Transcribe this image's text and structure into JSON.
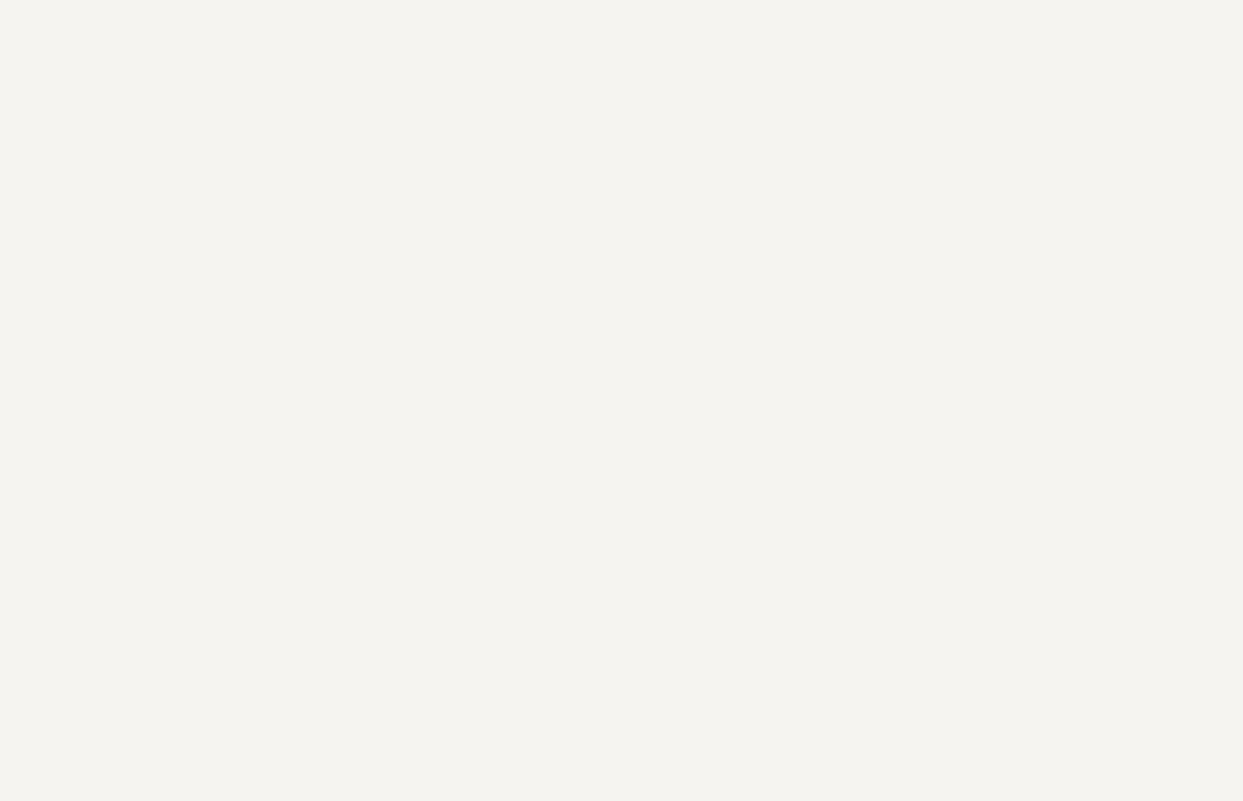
{
  "title": "STABILIZER 5/24V 1.915.106 22.6.83 /1.915.108",
  "colors": {
    "bg": "#f5f4f0",
    "ink": "#1c1c1c"
  },
  "note": [
    {
      "t": "∂",
      "x": 605,
      "y": 651,
      "s": 7
    },
    {
      "t": "R",
      "x": 614,
      "y": 651
    },
    {
      "t": "L",
      "x": 620,
      "y": 653,
      "s": 4.5
    },
    {
      "t": "= ∞ ,",
      "x": 626,
      "y": 651
    },
    {
      "t": "R",
      "x": 646,
      "y": 651
    },
    {
      "t": "v",
      "x": 652,
      "y": 653,
      "s": 4.5
    },
    {
      "t": "= ∞ :",
      "x": 658,
      "y": 651
    },
    {
      "t": "U",
      "x": 677,
      "y": 651
    },
    {
      "t": "out",
      "x": 684,
      "y": 653,
      "s": 4.5
    },
    {
      "t": "= 24V",
      "x": 695,
      "y": 651
    },
    {
      "t": "I",
      "x": 726,
      "y": 651
    },
    {
      "t": "out",
      "x": 730,
      "y": 653,
      "s": 4.5
    },
    {
      "t": "ca 4,5A",
      "x": 742,
      "y": 651
    }
  ],
  "connector": {
    "pin_first": 32,
    "pin_last": 1,
    "tracking_label": "TRACKING",
    "tracking_letters": [
      "A",
      "B",
      "C",
      "D",
      "E",
      "F",
      "G"
    ],
    "tracking_pins": [
      31,
      30,
      29,
      28,
      27,
      26,
      25
    ],
    "output_label": "OUTPUT",
    "output_plus_pins": [
      24,
      23,
      22,
      21
    ],
    "key_label": "KEY",
    "key_pin": 15,
    "rv_pin": 13,
    "rc_from_pin": 18,
    "aux_pin": 20,
    "out_label": "OUT.",
    "out_minus_pins": [
      11,
      10,
      9,
      8
    ],
    "inp_label": "INP.",
    "inp_plus_pins": [
      7,
      6,
      5
    ],
    "inp_minus_pins": [
      4,
      3,
      2
    ],
    "voltage_adjust": [
      "OUTPUT",
      "VOLTAGE",
      "ADJUST"
    ],
    "current_adjust": [
      "OUTPUT",
      "CURRENT",
      "ADJUST"
    ],
    "plus_mark": "+",
    "minus_mark": "−",
    "rv_label_main": "R",
    "rv_label_sub": "v",
    "rc_label_main": "R",
    "rc_label_sub": "c"
  },
  "labels": [
    {
      "t": "R",
      "x": 212,
      "y": 42,
      "s": 7
    },
    {
      "t": "c",
      "x": 219,
      "y": 44,
      "s": 5
    },
    {
      "t": "P4/18",
      "x": 170,
      "y": 61
    },
    {
      "t": "( 5 )",
      "x": 237,
      "y": 61
    },
    {
      "t": "P4/5",
      "x": 116,
      "y": 83
    },
    {
      "t": "P4/6",
      "x": 116,
      "y": 100
    },
    {
      "t": "P4/7",
      "x": 116,
      "y": 120
    },
    {
      "t": "INPUTS",
      "x": 138,
      "y": 140
    },
    {
      "t": "R2",
      "x": 245,
      "y": 114
    },
    {
      "t": "1,8k",
      "x": 245,
      "y": 123
    },
    {
      "t": "2X",
      "x": 281,
      "y": 151
    },
    {
      "t": "BC307B",
      "x": 264,
      "y": 160
    },
    {
      "t": "Q1",
      "x": 210,
      "y": 172
    },
    {
      "t": "Q2",
      "x": 312,
      "y": 175
    },
    {
      "t": "R3",
      "x": 314,
      "y": 195
    },
    {
      "t": "40k",
      "x": 314,
      "y": 215
    },
    {
      "t": "BC307B",
      "x": 381,
      "y": 194
    },
    {
      "t": "Q3",
      "x": 384,
      "y": 203
    },
    {
      "t": "C5",
      "x": 315,
      "y": 122
    },
    {
      "t": "4,7µ",
      "x": 310,
      "y": 131
    },
    {
      "t": "25V",
      "x": 311,
      "y": 139
    },
    {
      "t": "R1",
      "x": 266,
      "y": 89
    },
    {
      "t": "0,1",
      "x": 267,
      "y": 108
    },
    {
      "t": "R4",
      "x": 419,
      "y": 220
    },
    {
      "t": "10k",
      "x": 419,
      "y": 240
    },
    {
      "t": "P4/31",
      "x": 446,
      "y": 61
    },
    {
      "t": "A",
      "x": 477,
      "y": 75
    },
    {
      "t": "R12",
      "x": 444,
      "y": 114
    },
    {
      "t": "1k",
      "x": 449,
      "y": 123
    },
    {
      "t": "C7",
      "x": 416,
      "y": 154
    },
    {
      "t": "0,1µ",
      "x": 443,
      "y": 153
    },
    {
      "t": "D5",
      "x": 518,
      "y": 127
    },
    {
      "t": "ZPD 4,3V",
      "x": 511,
      "y": 136
    },
    {
      "t": "MV5753",
      "x": 566,
      "y": 105
    },
    {
      "t": "DL6",
      "x": 571,
      "y": 113
    },
    {
      "t": "R16",
      "x": 541,
      "y": 156
    },
    {
      "t": "560",
      "x": 543,
      "y": 164
    },
    {
      "t": "R21",
      "x": 579,
      "y": 148
    },
    {
      "t": "180",
      "x": 581,
      "y": 156
    },
    {
      "t": "Q7",
      "x": 567,
      "y": 212
    },
    {
      "t": "BC307B",
      "x": 556,
      "y": 220
    },
    {
      "t": "C9",
      "x": 634,
      "y": 147
    },
    {
      "t": "47µ",
      "x": 630,
      "y": 155
    },
    {
      "t": "6,3V",
      "x": 628,
      "y": 163
    },
    {
      "t": "4V",
      "x": 704,
      "y": 191,
      "a": "m"
    },
    {
      "t": "K",
      "x": 712,
      "y": 133
    },
    {
      "t": "A",
      "x": 715,
      "y": 164
    },
    {
      "t": "D7",
      "x": 729,
      "y": 163
    },
    {
      "t": "TL431",
      "x": 725,
      "y": 171
    },
    {
      "t": "REF",
      "x": 732,
      "y": 141,
      "s": 5
    },
    {
      "t": "R26",
      "x": 757,
      "y": 141
    },
    {
      "t": "40k",
      "x": 758,
      "y": 149
    },
    {
      "t": "R28",
      "x": 783,
      "y": 109
    },
    {
      "t": "3,3k",
      "x": 781,
      "y": 117
    },
    {
      "t": "BC307B",
      "x": 786,
      "y": 143
    },
    {
      "t": "Q13",
      "x": 790,
      "y": 151
    },
    {
      "t": "R27",
      "x": 785,
      "y": 176
    },
    {
      "t": "NTC",
      "x": 786,
      "y": 183
    },
    {
      "t": "16,7k",
      "x": 783,
      "y": 191
    },
    {
      "t": "R25",
      "x": 757,
      "y": 204
    },
    {
      "t": "15k",
      "x": 758,
      "y": 212
    },
    {
      "t": "R29",
      "x": 795,
      "y": 204
    },
    {
      "t": "2,7",
      "x": 797,
      "y": 212
    },
    {
      "t": "R22",
      "x": 697,
      "y": 253
    },
    {
      "t": "5,6k",
      "x": 694,
      "y": 261
    },
    {
      "t": "OPTIONAL :",
      "x": 742,
      "y": 248
    },
    {
      "t": "THERMAL SWITCH OFF",
      "x": 740,
      "y": 258,
      "s": 6
    },
    {
      "t": "R31",
      "x": 749,
      "y": 290,
      "s": 6
    },
    {
      "t": "2k",
      "x": 752,
      "y": 298,
      "s": 6
    },
    {
      "t": "C10",
      "x": 774,
      "y": 268,
      "s": 6
    },
    {
      "t": "47µ",
      "x": 776,
      "y": 276,
      "s": 6
    },
    {
      "t": "BC307B",
      "x": 770,
      "y": 289,
      "s": 6
    },
    {
      "t": "Q19",
      "x": 775,
      "y": 297,
      "s": 6
    },
    {
      "t": "BC237B",
      "x": 788,
      "y": 320,
      "s": 6
    },
    {
      "t": "Q12",
      "x": 792,
      "y": 328,
      "s": 6
    },
    {
      "t": "R27",
      "x": 748,
      "y": 352,
      "s": 6
    },
    {
      "t": "16,7k",
      "x": 744,
      "y": 360,
      "s": 6
    },
    {
      "t": "R38",
      "x": 788,
      "y": 350,
      "s": 6
    },
    {
      "t": "1k",
      "x": 792,
      "y": 358,
      "s": 6
    },
    {
      "t": "Q14",
      "x": 866,
      "y": 297
    },
    {
      "t": "BC237B",
      "x": 856,
      "y": 305
    },
    {
      "t": "BC307B",
      "x": 932,
      "y": 258
    },
    {
      "t": "Q15",
      "x": 942,
      "y": 266
    },
    {
      "t": "BC237B",
      "x": 980,
      "y": 257
    },
    {
      "t": "Q17",
      "x": 984,
      "y": 265
    },
    {
      "t": "D11",
      "x": 869,
      "y": 140
    },
    {
      "t": "1N4448",
      "x": 862,
      "y": 149
    },
    {
      "t": "R30",
      "x": 870,
      "y": 194
    },
    {
      "t": "100k",
      "x": 866,
      "y": 202
    },
    {
      "t": "P4/30",
      "x": 835,
      "y": 60
    },
    {
      "t": "B",
      "x": 859,
      "y": 77
    },
    {
      "t": "P4/29",
      "x": 902,
      "y": 60
    },
    {
      "t": "C",
      "x": 926,
      "y": 77
    },
    {
      "t": "P4/25",
      "x": 948,
      "y": 60
    },
    {
      "t": "G",
      "x": 977,
      "y": 77
    },
    {
      "t": "P4/27",
      "x": 993,
      "y": 60
    },
    {
      "t": "E",
      "x": 1021,
      "y": 77
    },
    {
      "t": "P4/21",
      "x": 1114,
      "y": 65
    },
    {
      "t": "P4/22",
      "x": 1114,
      "y": 81
    },
    {
      "t": "P4/23",
      "x": 1114,
      "y": 100
    },
    {
      "t": "P4/24",
      "x": 1114,
      "y": 115
    },
    {
      "t": "OUTPUTS",
      "x": 1056,
      "y": 129
    },
    {
      "t": "P2",
      "x": 1046,
      "y": 157
    },
    {
      "t": "0V",
      "x": 1043,
      "y": 165
    },
    {
      "t": "P3",
      "x": 1070,
      "y": 231
    },
    {
      "t": "−1V",
      "x": 1066,
      "y": 239
    },
    {
      "t": "R34",
      "x": 948,
      "y": 308
    },
    {
      "t": "100k",
      "x": 943,
      "y": 316
    },
    {
      "t": "R32",
      "x": 991,
      "y": 308
    },
    {
      "t": "100k",
      "x": 986,
      "y": 316
    },
    {
      "t": "R33",
      "x": 1044,
      "y": 308
    },
    {
      "t": "100k",
      "x": 1044,
      "y": 316
    },
    {
      "t": "BC307B",
      "x": 975,
      "y": 348
    },
    {
      "t": "Q16",
      "x": 979,
      "y": 356
    },
    {
      "t": "BC307B",
      "x": 1043,
      "y": 381
    },
    {
      "t": "Q18",
      "x": 1047,
      "y": 389
    },
    {
      "t": "4X",
      "x": 110,
      "y": 308
    },
    {
      "t": "2200µ",
      "x": 100,
      "y": 316
    },
    {
      "t": "40V",
      "x": 106,
      "y": 324
    },
    {
      "t": "C1",
      "x": 133,
      "y": 303,
      "s": 6
    },
    {
      "t": "C2",
      "x": 151,
      "y": 303,
      "s": 6
    },
    {
      "t": "C3",
      "x": 169,
      "y": 303,
      "s": 6
    },
    {
      "t": "C4",
      "x": 187,
      "y": 303,
      "s": 6
    },
    {
      "t": "R5",
      "x": 224,
      "y": 300
    },
    {
      "t": "2,7",
      "x": 224,
      "y": 308
    },
    {
      "t": "D2",
      "x": 260,
      "y": 291
    },
    {
      "t": "1N4448",
      "x": 244,
      "y": 301
    },
    {
      "t": "D3",
      "x": 260,
      "y": 313
    },
    {
      "t": "R6",
      "x": 241,
      "y": 333
    },
    {
      "t": "1k",
      "x": 245,
      "y": 352
    },
    {
      "t": "Q4",
      "x": 193,
      "y": 366
    },
    {
      "t": "BD136-16",
      "x": 174,
      "y": 379
    },
    {
      "t": "1N4448",
      "x": 313,
      "y": 357
    },
    {
      "t": "D4",
      "x": 317,
      "y": 365
    },
    {
      "t": "R8",
      "x": 378,
      "y": 362
    },
    {
      "t": "1k",
      "x": 381,
      "y": 382
    },
    {
      "t": "7",
      "x": 426,
      "y": 351
    },
    {
      "t": "3",
      "x": 464,
      "y": 354
    },
    {
      "t": "+",
      "x": 451,
      "y": 358,
      "s": 7
    },
    {
      "t": "2",
      "x": 464,
      "y": 387
    },
    {
      "t": "−",
      "x": 451,
      "y": 391,
      "s": 7
    },
    {
      "t": "6",
      "x": 408,
      "y": 369
    },
    {
      "t": "IC1",
      "x": 436,
      "y": 371
    },
    {
      "t": "TL071",
      "x": 431,
      "y": 380
    },
    {
      "t": "4",
      "x": 426,
      "y": 402
    },
    {
      "t": "C6",
      "x": 398,
      "y": 413
    },
    {
      "t": "100",
      "x": 419,
      "y": 412
    },
    {
      "t": "R7",
      "x": 303,
      "y": 449
    },
    {
      "t": "40k",
      "x": 302,
      "y": 458
    },
    {
      "t": "40k",
      "x": 533,
      "y": 289
    },
    {
      "t": "R13",
      "x": 531,
      "y": 297
    },
    {
      "t": "Q6",
      "x": 519,
      "y": 315
    },
    {
      "t": "BC307B",
      "x": 501,
      "y": 323
    },
    {
      "t": "R14",
      "x": 524,
      "y": 349
    },
    {
      "t": "40k",
      "x": 527,
      "y": 369
    },
    {
      "t": "R15",
      "x": 524,
      "y": 380
    },
    {
      "t": "40k",
      "x": 527,
      "y": 400
    },
    {
      "t": "R17",
      "x": 538,
      "y": 256
    },
    {
      "t": "110",
      "x": 540,
      "y": 264
    },
    {
      "t": "R20",
      "x": 591,
      "y": 256
    },
    {
      "t": "1M",
      "x": 595,
      "y": 264
    },
    {
      "t": "BC307B",
      "x": 631,
      "y": 297
    },
    {
      "t": "Q9",
      "x": 640,
      "y": 305
    },
    {
      "t": "Q10",
      "x": 641,
      "y": 410
    },
    {
      "t": "BC237B",
      "x": 627,
      "y": 418
    },
    {
      "t": "Q11",
      "x": 737,
      "y": 410
    },
    {
      "t": "BD135-16",
      "x": 734,
      "y": 418
    },
    {
      "t": "D8",
      "x": 701,
      "y": 442
    },
    {
      "t": "D9",
      "x": 701,
      "y": 470
    },
    {
      "t": "1N4448",
      "x": 674,
      "y": 499
    },
    {
      "t": "R23",
      "x": 645,
      "y": 459
    },
    {
      "t": "18k",
      "x": 648,
      "y": 467
    },
    {
      "t": "R24",
      "x": 728,
      "y": 459
    },
    {
      "t": "47",
      "x": 732,
      "y": 467
    },
    {
      "t": "R9",
      "x": 460,
      "y": 451
    },
    {
      "t": "0,27",
      "x": 453,
      "y": 463
    },
    {
      "t": "R10",
      "x": 509,
      "y": 451
    },
    {
      "t": "180",
      "x": 509,
      "y": 463
    },
    {
      "t": "T2800",
      "x": 445,
      "y": 511
    },
    {
      "t": "Q8",
      "x": 455,
      "y": 519
    },
    {
      "t": "T2",
      "x": 488,
      "y": 507,
      "s": 5.5
    },
    {
      "t": "T1",
      "x": 488,
      "y": 532,
      "s": 5.5
    },
    {
      "t": "R11",
      "x": 510,
      "y": 544
    },
    {
      "t": "1k",
      "x": 513,
      "y": 552
    },
    {
      "t": "R18",
      "x": 554,
      "y": 528
    },
    {
      "t": "68k",
      "x": 553,
      "y": 537
    },
    {
      "t": "R19",
      "x": 584,
      "y": 528
    },
    {
      "t": "3,9k",
      "x": 583,
      "y": 537
    },
    {
      "t": "C8",
      "x": 621,
      "y": 531
    },
    {
      "t": "4,7µ",
      "x": 621,
      "y": 539
    },
    {
      "t": "25V",
      "x": 621,
      "y": 547
    },
    {
      "t": "P4/13",
      "x": 517,
      "y": 613
    },
    {
      "t": "(11)",
      "x": 570,
      "y": 613
    },
    {
      "t": "R",
      "x": 549,
      "y": 616,
      "s": 6
    },
    {
      "t": "v",
      "x": 555,
      "y": 618,
      "s": 4.5
    },
    {
      "t": "P4/2",
      "x": 116,
      "y": 556
    },
    {
      "t": "P4/3",
      "x": 116,
      "y": 575
    },
    {
      "t": "P4/4",
      "x": 116,
      "y": 593
    },
    {
      "t": "INPUTS",
      "x": 138,
      "y": 614
    },
    {
      "t": "2N5634",
      "x": 226,
      "y": 550
    },
    {
      "t": "Q5",
      "x": 236,
      "y": 558
    },
    {
      "t": "D1",
      "x": 197,
      "y": 592
    },
    {
      "t": "1N4004",
      "x": 191,
      "y": 610
    },
    {
      "t": "D10",
      "x": 763,
      "y": 519
    },
    {
      "t": "MR502",
      "x": 756,
      "y": 528
    },
    {
      "t": "C11",
      "x": 845,
      "y": 517
    },
    {
      "t": "2200µ",
      "x": 845,
      "y": 525
    },
    {
      "t": "25V",
      "x": 845,
      "y": 533
    },
    {
      "t": "P4",
      "x": 1046,
      "y": 496
    },
    {
      "t": "− OUTPUT",
      "x": 1062,
      "y": 506
    },
    {
      "t": "P4/28",
      "x": 876,
      "y": 614
    },
    {
      "t": "D",
      "x": 901,
      "y": 597
    },
    {
      "t": "P4/26",
      "x": 1020,
      "y": 614
    },
    {
      "t": "F",
      "x": 1046,
      "y": 597
    },
    {
      "t": "P4/8",
      "x": 1117,
      "y": 559
    },
    {
      "t": "P4/9",
      "x": 1117,
      "y": 575
    },
    {
      "t": "P4/10",
      "x": 1117,
      "y": 591
    },
    {
      "t": "P4/11",
      "x": 1117,
      "y": 607
    },
    {
      "t": "OUTPUTS",
      "x": 1083,
      "y": 633
    },
    {
      "t": "MV5753",
      "x": 103,
      "y": 706
    },
    {
      "t": "K",
      "x": 146,
      "y": 729
    },
    {
      "t": "NE5532",
      "x": 188,
      "y": 703
    },
    {
      "t": "8",
      "x": 182,
      "y": 719,
      "a": "e",
      "s": 6
    },
    {
      "t": "7",
      "x": 182,
      "y": 729,
      "a": "e",
      "s": 6
    },
    {
      "t": "6",
      "x": 182,
      "y": 740,
      "a": "e",
      "s": 6
    },
    {
      "t": "5",
      "x": 182,
      "y": 750,
      "a": "e",
      "s": 6
    },
    {
      "t": "1",
      "x": 232,
      "y": 719,
      "s": 6
    },
    {
      "t": "2",
      "x": 232,
      "y": 729,
      "s": 6
    },
    {
      "t": "3",
      "x": 232,
      "y": 740,
      "s": 6
    },
    {
      "t": "4",
      "x": 232,
      "y": 750,
      "s": 6
    },
    {
      "t": "2N5634",
      "x": 271,
      "y": 661
    },
    {
      "t": "C",
      "x": 290,
      "y": 693,
      "s": 5.5
    },
    {
      "t": "B",
      "x": 277,
      "y": 716,
      "s": 5.5
    },
    {
      "t": "E",
      "x": 299,
      "y": 716,
      "s": 5.5
    },
    {
      "t": "BD135",
      "x": 355,
      "y": 691
    },
    {
      "t": "BD136",
      "x": 355,
      "y": 700
    },
    {
      "t": "E",
      "x": 355,
      "y": 732,
      "s": 5.5
    },
    {
      "t": "C",
      "x": 367,
      "y": 732,
      "s": 5.5
    },
    {
      "t": "B",
      "x": 379,
      "y": 732,
      "s": 5.5
    },
    {
      "t": "T 2800",
      "x": 426,
      "y": 700
    },
    {
      "t": "T1",
      "x": 423,
      "y": 732,
      "s": 5.5
    },
    {
      "t": "T2",
      "x": 436,
      "y": 732,
      "s": 5.5
    },
    {
      "t": "G",
      "x": 451,
      "y": 732,
      "s": 5.5
    },
    {
      "t": "BC307",
      "x": 500,
      "y": 692
    },
    {
      "t": "BC237",
      "x": 500,
      "y": 701
    },
    {
      "t": "E",
      "x": 502,
      "y": 740,
      "s": 5.5
    },
    {
      "t": "B",
      "x": 510,
      "y": 740,
      "s": 5.5
    },
    {
      "t": "C",
      "x": 517,
      "y": 740,
      "s": 5.5
    },
    {
      "t": "TL431",
      "x": 548,
      "y": 692
    },
    {
      "t": "TL430",
      "x": 548,
      "y": 701
    },
    {
      "t": "K",
      "x": 549,
      "y": 740,
      "s": 5.5
    },
    {
      "t": "A",
      "x": 557,
      "y": 740,
      "s": 5.5
    },
    {
      "t": "REF",
      "x": 564,
      "y": 740,
      "s": 5.5
    },
    {
      "t": "BOTTOM VIEW",
      "x": 350,
      "y": 766
    }
  ]
}
